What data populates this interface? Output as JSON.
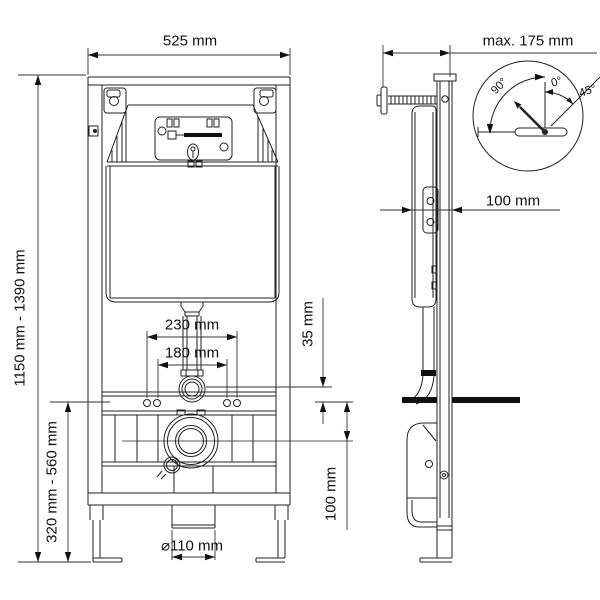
{
  "front_view": {
    "width_label": "525 mm",
    "height_range_label": "1150 mm - 1390 mm",
    "outlet_height_range_label": "320 mm - 560 mm",
    "fixing_width_outer_label": "230 mm",
    "fixing_width_inner_label": "180 mm",
    "flush_pipe_offset_label": "35 mm",
    "drain_center_offset_label": "100 mm",
    "drain_diameter_label": "⌀110 mm"
  },
  "side_view": {
    "wall_distance_label": "max. 175 mm",
    "frame_depth_label": "100 mm"
  },
  "bracket_detail": {
    "angle_90_label": "90°",
    "angle_0_label": "0°",
    "angle_45_label": "45°"
  },
  "colors": {
    "line": "#222222",
    "background": "#ffffff"
  }
}
